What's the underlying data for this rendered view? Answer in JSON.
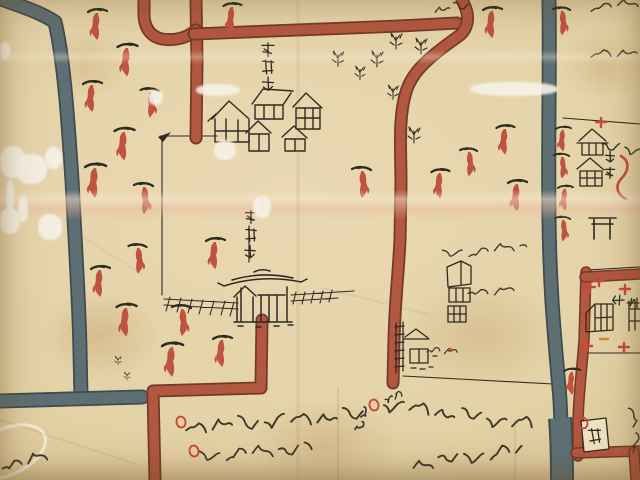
{
  "document": {
    "kind": "hand-drawn historical Japanese map (Edo-period style, detail view)",
    "media": "ink and color wash on creased aged paper",
    "inverted_text_note": "cursive inscriptions along the lower edge are written upside-down, read from the opposite side of the sheet"
  },
  "palette": {
    "paper": "#e5d3aa",
    "paper_light": "#f0e2c2",
    "ink": "#2e2a21",
    "road_red": "#b25740",
    "road_red_edge": "#74392a",
    "road_gray": "#5e6f73",
    "road_gray_edge": "#3e4b4f",
    "tree_red": "#c05340",
    "marker_red": "#c64a35",
    "marker_orange": "#cd8a3e"
  },
  "labels": {
    "residence_quarter": "御家敷",
    "shrine_gate_name": "泰清門",
    "hachiman_shrine": "八幡",
    "tenjin_shrine": "天神",
    "corner_seal": "悉"
  },
  "legend": {
    "red_band": "main road (vermilion wash)",
    "gray_band": "waterway / secondary road (blue-gray wash)",
    "red_plant": "tree symbol",
    "ink_structure": "building / shrine / gate",
    "red_circle": "inscription marker",
    "white_oval": "village cartouche (cut at edge)"
  },
  "kanji_labels": [
    {
      "id": "lab-res",
      "target": "lab-res",
      "text_key": "residence_quarter",
      "chars": [
        [
          268,
          50
        ],
        [
          268,
          67
        ],
        [
          268,
          84
        ]
      ],
      "s": 14,
      "rot": 0
    },
    {
      "id": "lab-gate",
      "target": "lab-gate",
      "text_key": "shrine_gate_name",
      "chars": [
        [
          251,
          217
        ],
        [
          251,
          235
        ],
        [
          250,
          252
        ]
      ],
      "s": 13,
      "rot": 0
    },
    {
      "id": "lab-hachi",
      "target": "lab-hachi",
      "text_key": "hachiman_shrine",
      "chars": [
        [
          610,
          157
        ],
        [
          610,
          173
        ]
      ],
      "s": 11,
      "rot": 0
    },
    {
      "id": "lab-tenjin",
      "target": "lab-tenjin",
      "text_key": "tenjin_shrine",
      "chars": [
        [
          618,
          300
        ],
        [
          633,
          303
        ]
      ],
      "s": 12,
      "rot": 90
    },
    {
      "id": "lab-seal",
      "target": "lab-seal",
      "text_key": "corner_seal",
      "chars": [
        [
          595,
          436
        ]
      ],
      "s": 15,
      "rot": -6
    }
  ],
  "inscriptions": [
    {
      "id": "south-line-1",
      "script": "kuzushiji cursive (illegible)",
      "inverted": true,
      "x": 186,
      "y": 427,
      "len": 184,
      "ang": -4,
      "amp": 5.5,
      "w": 1.9
    },
    {
      "id": "south-line-2",
      "script": "kuzushiji cursive (illegible)",
      "inverted": true,
      "x": 200,
      "y": 457,
      "len": 112,
      "ang": -5,
      "amp": 4.6,
      "w": 1.8
    },
    {
      "id": "south-right-line",
      "script": "kuzushiji cursive (illegible)",
      "inverted": true,
      "x": 384,
      "y": 404,
      "len": 156,
      "ang": 8,
      "amp": 5.2,
      "w": 1.9
    },
    {
      "id": "south-right-hook",
      "script": "kuzushiji cursive (illegible)",
      "inverted": true,
      "x": 356,
      "y": 430,
      "len": 24,
      "ang": -60,
      "amp": 3,
      "w": 1.7
    },
    {
      "id": "south-right-small",
      "script": "kuzushiji cursive (illegible)",
      "inverted": true,
      "x": 385,
      "y": 399,
      "len": 17,
      "ang": -15,
      "amp": 3,
      "w": 1.4
    },
    {
      "id": "south-line-3",
      "script": "kuzushiji cursive (illegible)",
      "inverted": true,
      "x": 413,
      "y": 464,
      "len": 110,
      "ang": -7,
      "amp": 5,
      "w": 1.9
    },
    {
      "id": "corner-cartouche-text",
      "script": "kuzushiji cursive (illegible)",
      "inverted": true,
      "x": 2,
      "y": 465,
      "len": 52,
      "ang": -10,
      "amp": 4.5,
      "w": 1.9
    },
    {
      "id": "top-right-1",
      "script": "kuzushiji cursive (cut at edge)",
      "inverted": false,
      "x": 591,
      "y": 7,
      "len": 47,
      "ang": -4,
      "amp": 3,
      "w": 1.5
    },
    {
      "id": "top-right-2",
      "script": "kuzushiji cursive (illegible)",
      "inverted": false,
      "x": 591,
      "y": 56,
      "len": 46,
      "ang": -7,
      "amp": 3.6,
      "w": 1.5
    },
    {
      "id": "tower-note-1",
      "script": "kuzushiji cursive (illegible)",
      "inverted": true,
      "x": 443,
      "y": 255,
      "len": 84,
      "ang": -6,
      "amp": 3.6,
      "w": 1.35
    },
    {
      "id": "tower-note-2",
      "script": "kuzushiji cursive (illegible)",
      "inverted": true,
      "x": 468,
      "y": 293,
      "len": 46,
      "ang": -5,
      "amp": 3.2,
      "w": 1.35
    },
    {
      "id": "gate-note",
      "script": "kuzushiji cursive (illegible)",
      "inverted": true,
      "x": 427,
      "y": 352,
      "len": 30,
      "ang": -5,
      "amp": 2.6,
      "w": 1.2
    },
    {
      "id": "top-center-note",
      "script": "kuzushiji cursive (cut at edge)",
      "inverted": false,
      "x": 435,
      "y": 10,
      "len": 34,
      "ang": -8,
      "amp": 3,
      "w": 1.4
    },
    {
      "id": "district-edge-note",
      "script": "kuzushiji cursive (vertical)",
      "inverted": false,
      "x": 633,
      "y": 408,
      "len": 44,
      "ang": 86,
      "amp": 3,
      "w": 1.5
    },
    {
      "id": "hachiman-note",
      "script": "kuzushiji cursive (illegible)",
      "inverted": false,
      "x": 602,
      "y": 147,
      "len": 40,
      "ang": 6,
      "amp": 4,
      "w": 1.5
    }
  ],
  "features": {
    "trees": [
      [
        97,
        12,
        1,
        0
      ],
      [
        127,
        47,
        1.05,
        0
      ],
      [
        92,
        84,
        1,
        0
      ],
      [
        150,
        91,
        0.95,
        1
      ],
      [
        124,
        131,
        1.05,
        0
      ],
      [
        95,
        167,
        1.1,
        0
      ],
      [
        144,
        186,
        1,
        1
      ],
      [
        232,
        6,
        0.95,
        0
      ],
      [
        362,
        170,
        1,
        1
      ],
      [
        440,
        172,
        0.95,
        0
      ],
      [
        469,
        151,
        0.9,
        1
      ],
      [
        505,
        128,
        0.95,
        0
      ],
      [
        517,
        183,
        1,
        0
      ],
      [
        492,
        10,
        1,
        0
      ],
      [
        562,
        10,
        0.9,
        1
      ],
      [
        100,
        269,
        1,
        0
      ],
      [
        138,
        247,
        0.95,
        1
      ],
      [
        215,
        241,
        1,
        0
      ],
      [
        126,
        307,
        1.05,
        0
      ],
      [
        182,
        308,
        1,
        1
      ],
      [
        172,
        346,
        1.1,
        0
      ],
      [
        222,
        339,
        1,
        0
      ],
      [
        563,
        129,
        0.8,
        0
      ],
      [
        562,
        156,
        0.8,
        1
      ],
      [
        565,
        188,
        0.8,
        0
      ],
      [
        563,
        219,
        0.8,
        1
      ],
      [
        572,
        371,
        0.85,
        0
      ]
    ],
    "grass": [
      [
        396,
        33,
        1
      ],
      [
        421,
        38,
        1
      ],
      [
        377,
        51,
        1
      ],
      [
        338,
        51,
        0.95
      ],
      [
        393,
        85,
        0.9
      ],
      [
        414,
        127,
        1
      ],
      [
        360,
        66,
        0.85
      ],
      [
        118,
        356,
        0.55
      ],
      [
        127,
        372,
        0.5
      ]
    ],
    "red_circles": [
      [
        181,
        422
      ],
      [
        194,
        451
      ],
      [
        374,
        405
      ],
      [
        583,
        423
      ]
    ],
    "red_marks": [
      {
        "x": 590,
        "y": 287,
        "k": 0
      },
      {
        "x": 587,
        "y": 346,
        "k": 0
      },
      {
        "x": 625,
        "y": 289,
        "k": 0
      },
      {
        "x": 624,
        "y": 347,
        "k": 0
      },
      {
        "x": 599,
        "y": 281,
        "k": 0
      },
      {
        "x": 601,
        "y": 122,
        "k": 0
      },
      {
        "x": 262,
        "y": 203,
        "k": 1
      },
      {
        "x": 449,
        "y": 349,
        "k": 2
      },
      {
        "x": 604,
        "y": 339,
        "k": 3
      }
    ],
    "damage_patches": [
      [
        0,
        146,
        26,
        32
      ],
      [
        15,
        154,
        32,
        30
      ],
      [
        45,
        147,
        17,
        22
      ],
      [
        0,
        208,
        20,
        26
      ],
      [
        38,
        214,
        24,
        26
      ],
      [
        148,
        90,
        15,
        15
      ],
      [
        196,
        84,
        44,
        12
      ],
      [
        214,
        140,
        22,
        20
      ],
      [
        470,
        82,
        88,
        14
      ],
      [
        253,
        196,
        18,
        22
      ],
      [
        0,
        42,
        10,
        18
      ],
      [
        6,
        180,
        8,
        34
      ],
      [
        18,
        196,
        10,
        26
      ]
    ]
  }
}
